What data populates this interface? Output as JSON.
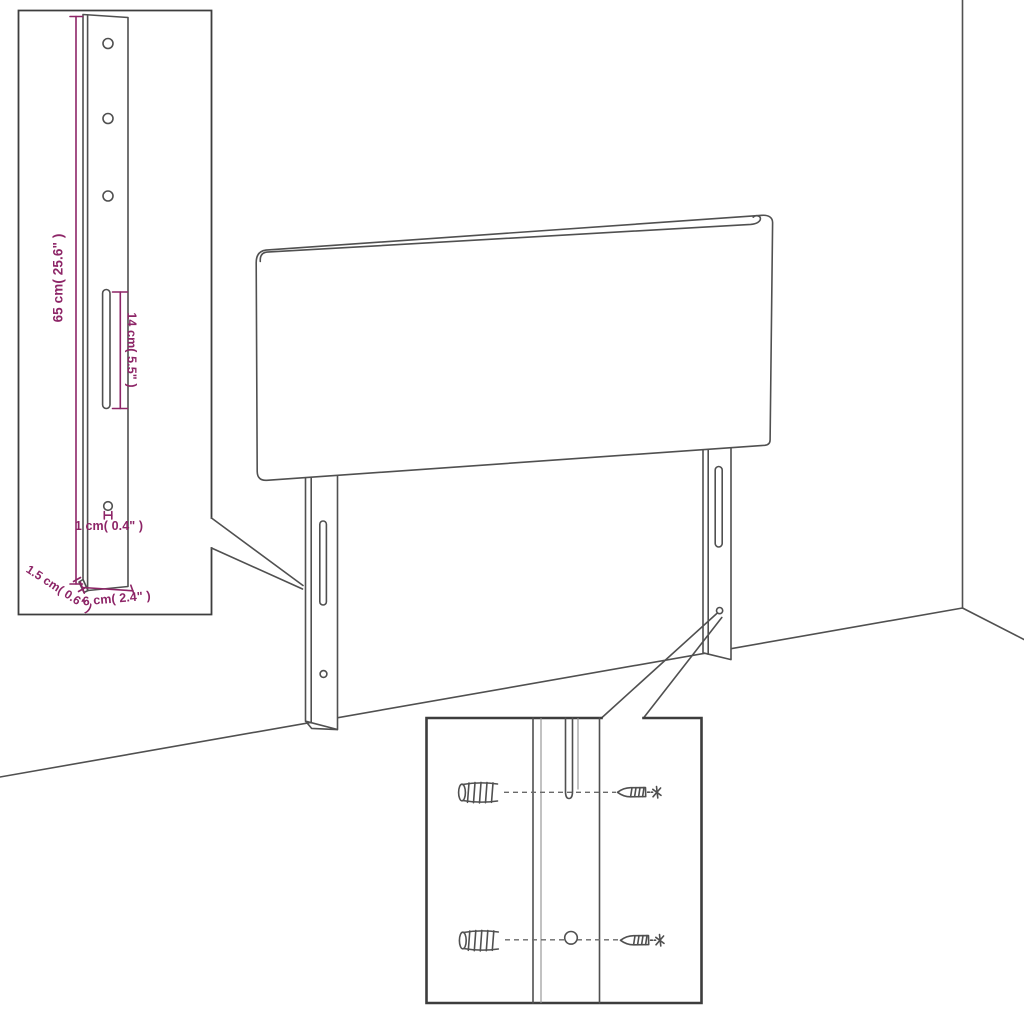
{
  "diagram": {
    "colors": {
      "line": "#505050",
      "inset_border": "#3d3d3d",
      "dimension": "#8d2567",
      "background": "#ffffff"
    },
    "bracket_detail": {
      "dim_height": "65 cm( 25.6\" )",
      "dim_slot_length": "14 cm( 5.5\" )",
      "dim_hole_diameter": "1 cm( 0.4\" )",
      "dim_bottom_width": "6 cm( 2.4\" )",
      "dim_thickness": "1.5 cm( 0.6\" )"
    },
    "mounting_detail": {
      "icons": [
        "wall-plug-icon",
        "wall-plug-icon",
        "screw-icon",
        "screw-icon"
      ]
    }
  }
}
